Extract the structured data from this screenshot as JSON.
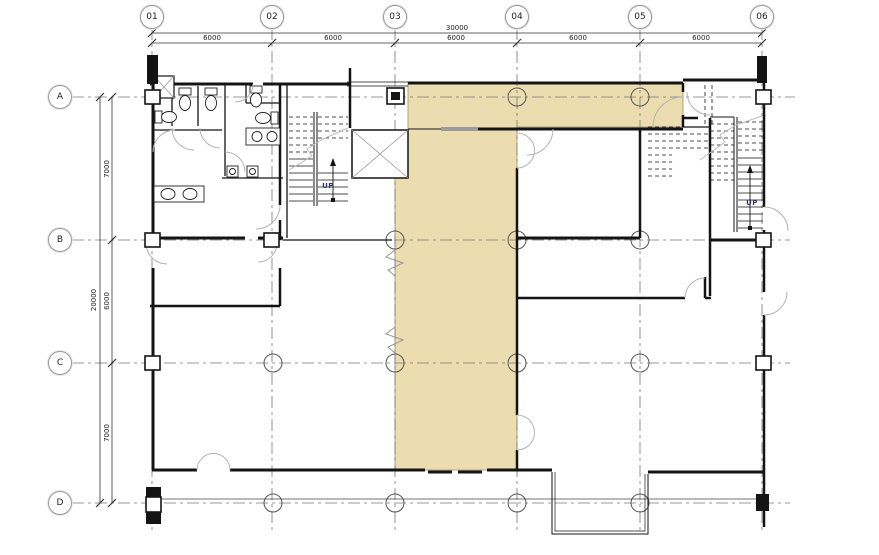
{
  "drawing": {
    "type": "architectural-floor-plan",
    "grid": {
      "columns": [
        {
          "label": "01"
        },
        {
          "label": "02"
        },
        {
          "label": "03"
        },
        {
          "label": "04"
        },
        {
          "label": "05"
        },
        {
          "label": "06"
        }
      ],
      "rows": [
        {
          "label": "A"
        },
        {
          "label": "B"
        },
        {
          "label": "C"
        },
        {
          "label": "D"
        }
      ]
    },
    "dimensions": {
      "top": {
        "total": "30000",
        "segments": [
          "6000",
          "6000",
          "6000",
          "6000",
          "6000"
        ]
      },
      "left": {
        "total": "20000",
        "segments": [
          "7000",
          "6000",
          "7000"
        ]
      }
    },
    "annotations": {
      "stair_left_up": "UP",
      "stair_right_up": "UP"
    },
    "colors": {
      "highlight_area": "#ecddb0",
      "walls": "#141414",
      "grid_lines": "#777777",
      "door_swings": "#b3b3b3"
    }
  }
}
